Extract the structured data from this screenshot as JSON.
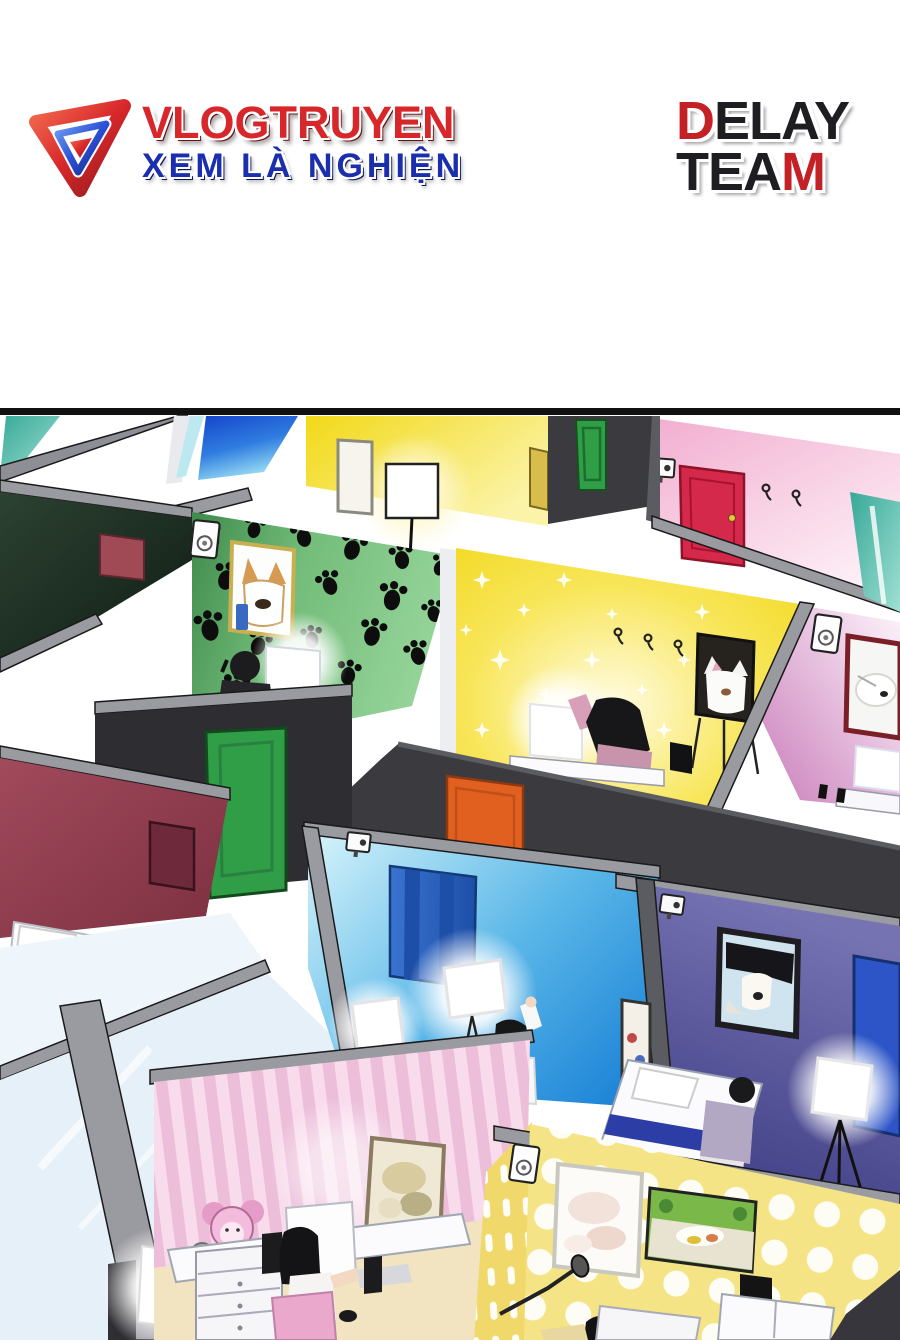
{
  "header": {
    "site_logo": {
      "title": "VLOGTRUYEN",
      "tagline": "XEM LÀ NGHIỆN"
    },
    "team_logo": {
      "line1_red": "D",
      "line1_black": "ELAY",
      "line2_black": "TEA",
      "line2_red": "M"
    }
  },
  "palette": {
    "logo_red": "#d8272b",
    "logo_blue": "#1b2fae",
    "team_black": "#1e1e22",
    "team_red": "#c42127",
    "panel_border": "#111111",
    "beam": "#9a9aa1",
    "beam_dark": "#5b5b62",
    "wall_dark": "#3a3a3f",
    "wall_dark2": "#2d2d32",
    "olive_wall": "#24342a",
    "paw_green": "#74bd7a",
    "door_green": "#2f9e47",
    "door_orange": "#e2601f",
    "door_red": "#d4294a",
    "door_maroon": "#6e2a3a",
    "door_blue": "#2a5fc0",
    "door_blue2": "#2d55c8",
    "yellow_room": "#f2dc2c",
    "star_yellow": "#f6e133",
    "pink_room": "#f2aed0",
    "magenta_room": "#c87ab8",
    "teal_glass": "#37a897",
    "cyan_room": "#1f86d8",
    "purple_room": "#55539a",
    "maroon_wall": "#96404f",
    "stripe_pink": "#ecbeda",
    "polka_yellow": "#f5e485",
    "floor_tan": "#f0e3b4",
    "glass": "#eef5fb"
  },
  "panel": {
    "description": "Isometric overhead view of many small vlogging cubicle rooms, each decorated differently, with streamers at desks, beds, studio lights, wall cameras and speakers",
    "rooms": [
      {
        "name": "yellow-lamp-room",
        "feature": "floor lamp and blank canvas"
      },
      {
        "name": "pink-red-door-room",
        "feature": "red door and wall hooks"
      },
      {
        "name": "green-paw-room",
        "feature": "black paw-print wallpaper, corgi portrait, streamer at desk"
      },
      {
        "name": "yellow-star-room",
        "feature": "star wallpaper, cat poster on easel, woman at desk"
      },
      {
        "name": "magenta-room",
        "feature": "white dog portrait and monitor"
      },
      {
        "name": "maroon-room",
        "feature": "bed with white pillow"
      },
      {
        "name": "cyan-room",
        "feature": "blue door, two studio lights, man waving"
      },
      {
        "name": "purple-room",
        "feature": "dog photo, bed, kneeling person, tripod light"
      },
      {
        "name": "pink-stripe-room",
        "feature": "plush elephant, desk with monitor, woman on pink chair"
      },
      {
        "name": "yellow-polka-room",
        "feature": "polka-dot wall, two framed pictures, boom mic"
      }
    ]
  }
}
